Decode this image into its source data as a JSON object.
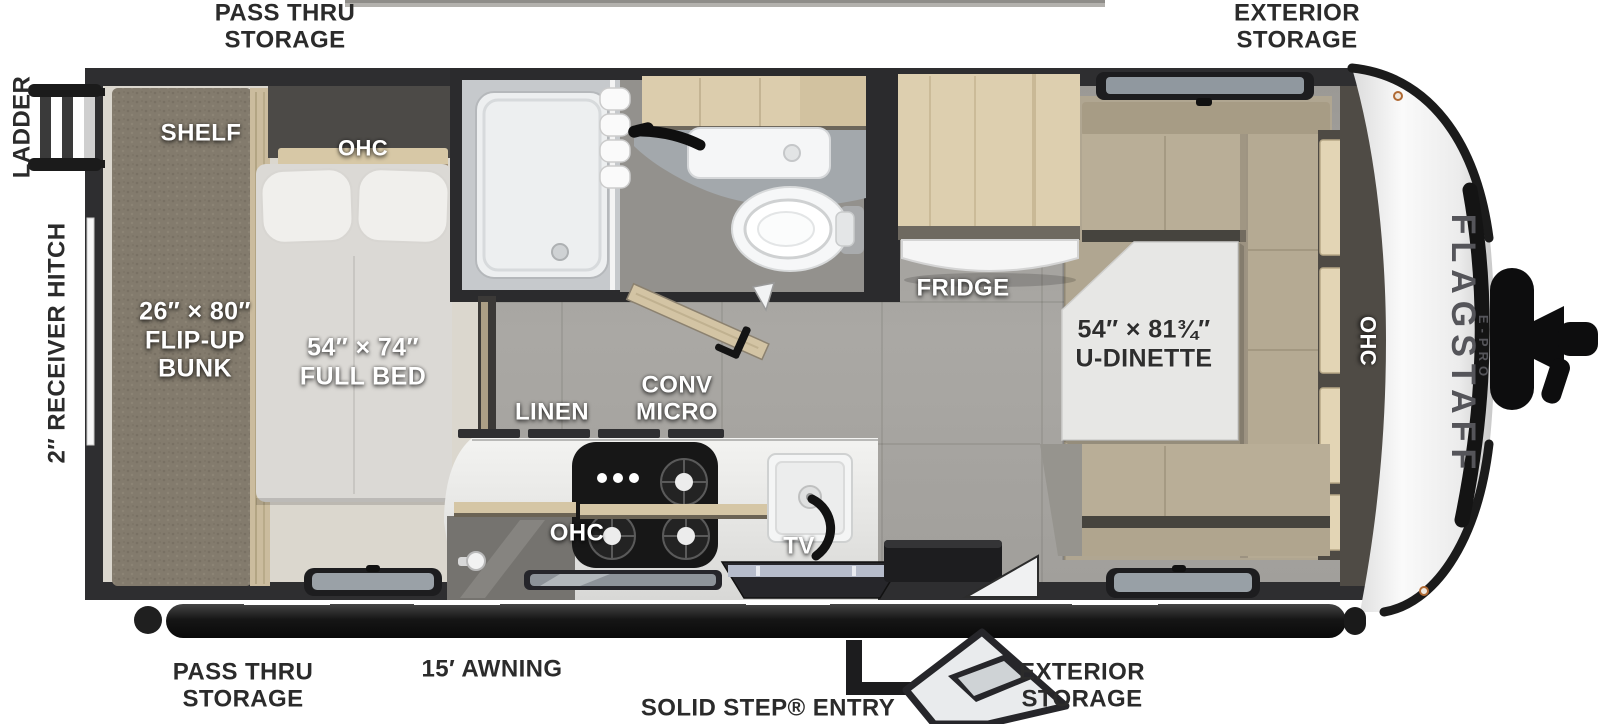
{
  "brand": {
    "name": "FLAGSTAFF",
    "sub": "E-PRO"
  },
  "exterior_labels": {
    "top_pass_thru": "PASS THRU STORAGE",
    "top_exterior": "EXTERIOR STORAGE",
    "bottom_pass_thru": "PASS THRU STORAGE",
    "awning": "15′ AWNING",
    "entry": "SOLID STEP® ENTRY",
    "bottom_exterior": "EXTERIOR STORAGE",
    "ladder": "LADDER",
    "hitch": "2″ RECEIVER HITCH"
  },
  "interior_labels": {
    "shelf": "SHELF",
    "bed_ohc": "OHC",
    "bunk": {
      "dim": "26″ × 80″",
      "name1": "FLIP-UP",
      "name2": "BUNK"
    },
    "full_bed": {
      "dim": "54″ × 74″",
      "name": "FULL BED"
    },
    "linen": "LINEN",
    "conv_micro": {
      "line1": "CONV",
      "line2": "MICRO"
    },
    "kitchen_ohc": "OHC",
    "tv": "TV",
    "fridge": "FRIDGE",
    "dinette": {
      "dim": "54″ × 81¾″",
      "name": "U-DINETTE"
    },
    "front_ohc": "OHC"
  },
  "palette": {
    "wall": "#2e2e30",
    "tile_floor": "#a8a6a2",
    "bedroom_floor": "#dbd7ce",
    "carpet": "#b0a691",
    "wood": "#d9cbab",
    "cushion": "#b9ae97",
    "front_cap": "#ededed",
    "trim_dark": "#1b1b1b"
  }
}
